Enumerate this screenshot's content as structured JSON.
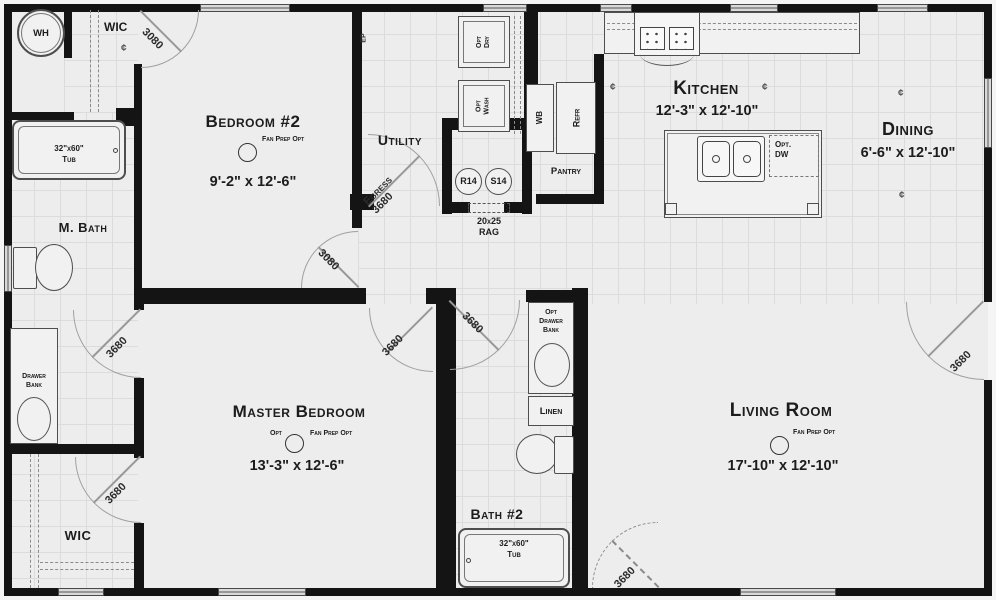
{
  "rooms": {
    "bedroom2": {
      "name": "Bedroom #2",
      "dims": "9'-2\" x 12'-6\"",
      "fan_note": "Fan Prep Opt"
    },
    "master_bedroom": {
      "name": "Master Bedroom",
      "dims": "13'-3\" x 12'-6\"",
      "opt_note": "Opt",
      "fan_note": "Fan Prep Opt"
    },
    "living_room": {
      "name": "Living Room",
      "dims": "17'-10\" x 12'-10\"",
      "fan_note": "Fan Prep Opt"
    },
    "kitchen": {
      "name": "Kitchen",
      "dims": "12'-3\" x 12'-10\""
    },
    "dining": {
      "name": "Dining",
      "dims": "6'-6\" x 12'-10\""
    },
    "m_bath": {
      "name": "M. Bath"
    },
    "bath2": {
      "name": "Bath #2"
    },
    "utility": {
      "name": "Utility"
    },
    "wic_upper": {
      "name": "WIC"
    },
    "wic_lower": {
      "name": "WIC"
    },
    "pantry": {
      "name": "Pantry"
    },
    "linen": {
      "name": "Linen"
    }
  },
  "fixtures": {
    "water_heater": "WH",
    "tub": {
      "size": "32\"x60\"",
      "label": "Tub"
    },
    "drawer_bank": {
      "l1": "Drawer",
      "l2": "Bank"
    },
    "opt_drawer_bank": {
      "l1": "Opt",
      "l2": "Drawer",
      "l3": "Bank"
    },
    "opt_dryer": {
      "l1": "Opt",
      "l2": "Dry"
    },
    "opt_washer": {
      "l1": "Opt",
      "l2": "Wash"
    },
    "wrap_board": "WB",
    "refrigerator": "Refr",
    "vent_r14": "R14",
    "vent_s14": "S14",
    "rag": {
      "l1": "20x25",
      "l2": "RAG"
    },
    "opt_dishwasher": {
      "l1": "Opt.",
      "l2": "DW"
    },
    "elec_panel": "EP"
  },
  "doors": {
    "size_3080": "3080",
    "size_3680": "3680",
    "egress_label": "Egress"
  },
  "symbols": {
    "centerline": "¢"
  },
  "colors": {
    "wall": "#141414",
    "floor": "#ededed",
    "grid_line": "#dcdcdc",
    "door_swing": "#989898"
  }
}
